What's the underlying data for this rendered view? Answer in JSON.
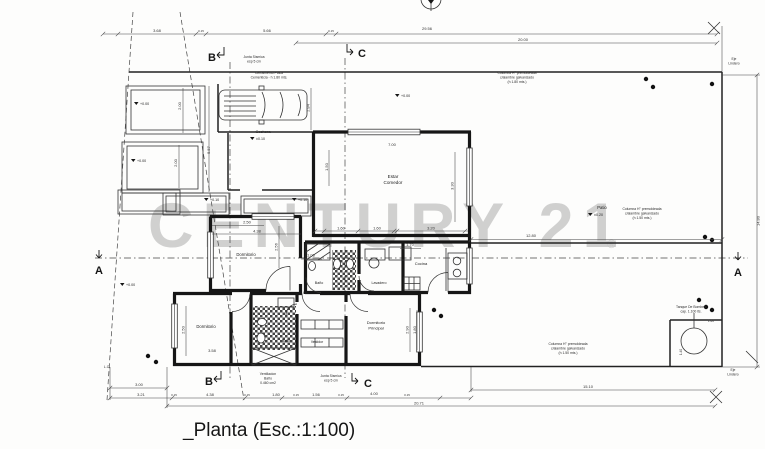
{
  "title": "_Planta (Esc.:1:100)",
  "watermark": {
    "text": "CENTURY 21",
    "reg": "®"
  },
  "rooms": [
    {
      "name": "cochera",
      "x": 263,
      "y": 133,
      "s": 4,
      "lines": [
        "Cochera"
      ]
    },
    {
      "name": "estar-comedor",
      "x": 393,
      "y": 178,
      "s": 4.6,
      "lines": [
        "Estar",
        "Comedor"
      ]
    },
    {
      "name": "dormitorio-1",
      "x": 246,
      "y": 256,
      "s": 4.2,
      "lines": [
        "Dormitorio"
      ]
    },
    {
      "name": "banio-1",
      "x": 319,
      "y": 284,
      "s": 3.6,
      "lines": [
        "Baño"
      ]
    },
    {
      "name": "lavadero",
      "x": 379,
      "y": 284,
      "s": 3.6,
      "lines": [
        "Lavadero"
      ]
    },
    {
      "name": "cocina",
      "x": 421,
      "y": 265,
      "s": 4,
      "lines": [
        "Cocina"
      ]
    },
    {
      "name": "hall",
      "x": 306,
      "y": 294,
      "s": 3.4,
      "lines": [
        "Hall"
      ]
    },
    {
      "name": "dormitorio-2",
      "x": 206,
      "y": 328,
      "s": 4.2,
      "lines": [
        "Dormitorio"
      ]
    },
    {
      "name": "banio-2",
      "x": 286,
      "y": 342,
      "s": 3.4,
      "lines": [
        "Baño"
      ]
    },
    {
      "name": "vestidor",
      "x": 317,
      "y": 343,
      "s": 3.4,
      "lines": [
        "Vestidor"
      ]
    },
    {
      "name": "dormitorio-principal",
      "x": 376,
      "y": 324,
      "s": 4,
      "lines": [
        "Dormitorio",
        "Principal"
      ]
    },
    {
      "name": "patio",
      "x": 602,
      "y": 209,
      "s": 4.2,
      "lines": [
        "Patio"
      ]
    }
  ],
  "annotations": [
    {
      "name": "junta-sismica-top",
      "x": 254,
      "y": 58,
      "lines": [
        "Junta Sismica",
        "esp 5 cm"
      ]
    },
    {
      "name": "cerramiento-placa",
      "x": 269,
      "y": 74,
      "lines": [
        "Cerramiento Placa",
        "Cementicia - h 1.80 mts."
      ]
    },
    {
      "name": "columna-top-right",
      "x": 517,
      "y": 74,
      "lines": [
        "Columna H° premoldeada",
        "c/alambre galvanizado",
        "(h 1.80 mts.)"
      ]
    },
    {
      "name": "columna-right",
      "x": 642,
      "y": 210,
      "lines": [
        "Columna H° premoldeada",
        "c/alambre galvanizado",
        "(h 1.50 mts.)"
      ]
    },
    {
      "name": "columna-bottom",
      "x": 568,
      "y": 345,
      "lines": [
        "Columna H° premoldeada",
        "c/alambre galvanizado",
        "(h 1.50 mts.)"
      ]
    },
    {
      "name": "tanque-bombeo",
      "x": 691,
      "y": 308,
      "lines": [
        "Tanque De Bombeo",
        "cap. 1.100 lts."
      ]
    },
    {
      "name": "ventilacion-banio",
      "x": 268,
      "y": 375,
      "lines": [
        "Ventilacion",
        "Baño",
        "0.460 cm2"
      ]
    },
    {
      "name": "junta-sismica-bottom",
      "x": 331,
      "y": 377,
      "lines": [
        "Junta Sismica",
        "esp 5 cm"
      ]
    },
    {
      "name": "eje-lindero-top",
      "x": 734,
      "y": 60,
      "lines": [
        "Eje",
        "Lindero"
      ]
    },
    {
      "name": "eje-lindero-bottom",
      "x": 733,
      "y": 371,
      "lines": [
        "Eje",
        "Lindero"
      ]
    },
    {
      "name": "lc-mark",
      "x": 107,
      "y": 368,
      "lines": [
        "L.C."
      ]
    }
  ],
  "dimensions": [
    {
      "t": "3.68",
      "x": 157,
      "y": 32
    },
    {
      "t": "5.66",
      "x": 267,
      "y": 32
    },
    {
      "t": "29.56",
      "x": 427,
      "y": 30
    },
    {
      "t": "20.00",
      "x": 523,
      "y": 41
    },
    {
      "t": "0.15",
      "x": 201,
      "y": 32,
      "s": 3
    },
    {
      "t": "0.15",
      "x": 331,
      "y": 32,
      "s": 3
    },
    {
      "t": "14.80",
      "x": 759.5,
      "y": 221,
      "r": -90
    },
    {
      "t": "12.80",
      "x": 531,
      "y": 237
    },
    {
      "t": "3.00",
      "x": 139,
      "y": 386
    },
    {
      "t": "3.21",
      "x": 141,
      "y": 396
    },
    {
      "t": "4.38",
      "x": 210,
      "y": 396
    },
    {
      "t": "1.80",
      "x": 276,
      "y": 396
    },
    {
      "t": "1.56",
      "x": 316,
      "y": 396
    },
    {
      "t": "4.00",
      "x": 374,
      "y": 395
    },
    {
      "t": "20.71",
      "x": 419,
      "y": 404.5
    },
    {
      "t": "15.10",
      "x": 588,
      "y": 388
    },
    {
      "t": "0.15",
      "x": 174,
      "y": 396,
      "s": 3
    },
    {
      "t": "0.15",
      "x": 247,
      "y": 396,
      "s": 3
    },
    {
      "t": "0.15",
      "x": 296,
      "y": 396,
      "s": 3
    },
    {
      "t": "0.15",
      "x": 341,
      "y": 396,
      "s": 3
    },
    {
      "t": "0.15",
      "x": 407,
      "y": 396,
      "s": 3
    },
    {
      "t": "2.00",
      "x": 181,
      "y": 106,
      "r": -90
    },
    {
      "t": "2.00",
      "x": 177,
      "y": 163,
      "r": -90
    },
    {
      "t": "5.57",
      "x": 210,
      "y": 150,
      "r": -90
    },
    {
      "t": "2.84",
      "x": 309.5,
      "y": 108,
      "r": -90
    },
    {
      "t": "7.00",
      "x": 392,
      "y": 146
    },
    {
      "t": "1.50",
      "x": 328,
      "y": 167,
      "r": -90
    },
    {
      "t": "3.30",
      "x": 453.5,
      "y": 186,
      "r": -90
    },
    {
      "t": "1.60",
      "x": 341,
      "y": 229.5
    },
    {
      "t": "1.60",
      "x": 377,
      "y": 229.5
    },
    {
      "t": "3.20",
      "x": 431,
      "y": 229.5
    },
    {
      "t": "2.50",
      "x": 247,
      "y": 223.5
    },
    {
      "t": "4.38",
      "x": 257,
      "y": 232.5
    },
    {
      "t": "2.56",
      "x": 277.5,
      "y": 247,
      "r": -90
    },
    {
      "t": "1.06",
      "x": 311,
      "y": 256.5
    },
    {
      "t": "1.70",
      "x": 410,
      "y": 246
    },
    {
      "t": "3.58",
      "x": 212,
      "y": 352
    },
    {
      "t": "2.50",
      "x": 184.5,
      "y": 330,
      "r": -90
    },
    {
      "t": "2.90",
      "x": 408.5,
      "y": 330,
      "r": -90
    },
    {
      "t": "1.80",
      "x": 416,
      "y": 330,
      "r": -90
    },
    {
      "t": "1.60",
      "x": 711,
      "y": 322,
      "s": 3.2
    },
    {
      "t": "1.40",
      "x": 682,
      "y": 352,
      "r": -90,
      "s": 3.2
    }
  ],
  "levels": [
    {
      "t": "+0.00",
      "x": 140,
      "y": 105
    },
    {
      "t": "+0.00",
      "x": 137,
      "y": 162
    },
    {
      "t": "+0.00",
      "x": 126,
      "y": 286
    },
    {
      "t": "+0.10",
      "x": 210,
      "y": 201
    },
    {
      "t": "+0.10",
      "x": 298,
      "y": 201
    },
    {
      "t": "+0.00",
      "x": 401,
      "y": 97
    },
    {
      "t": "±0.10",
      "x": 256,
      "y": 140
    },
    {
      "t": "±0.20",
      "x": 594,
      "y": 216
    }
  ],
  "sections": [
    {
      "id": "b-top",
      "t": "B",
      "x": 212,
      "y": 61
    },
    {
      "id": "c-top",
      "t": "C",
      "x": 362,
      "y": 57
    },
    {
      "id": "a-left",
      "t": "A",
      "x": 99,
      "y": 274
    },
    {
      "id": "a-right",
      "t": "A",
      "x": 738,
      "y": 276
    },
    {
      "id": "b-bottom",
      "t": "B",
      "x": 209,
      "y": 385
    },
    {
      "id": "c-bottom",
      "t": "C",
      "x": 368,
      "y": 387
    }
  ]
}
